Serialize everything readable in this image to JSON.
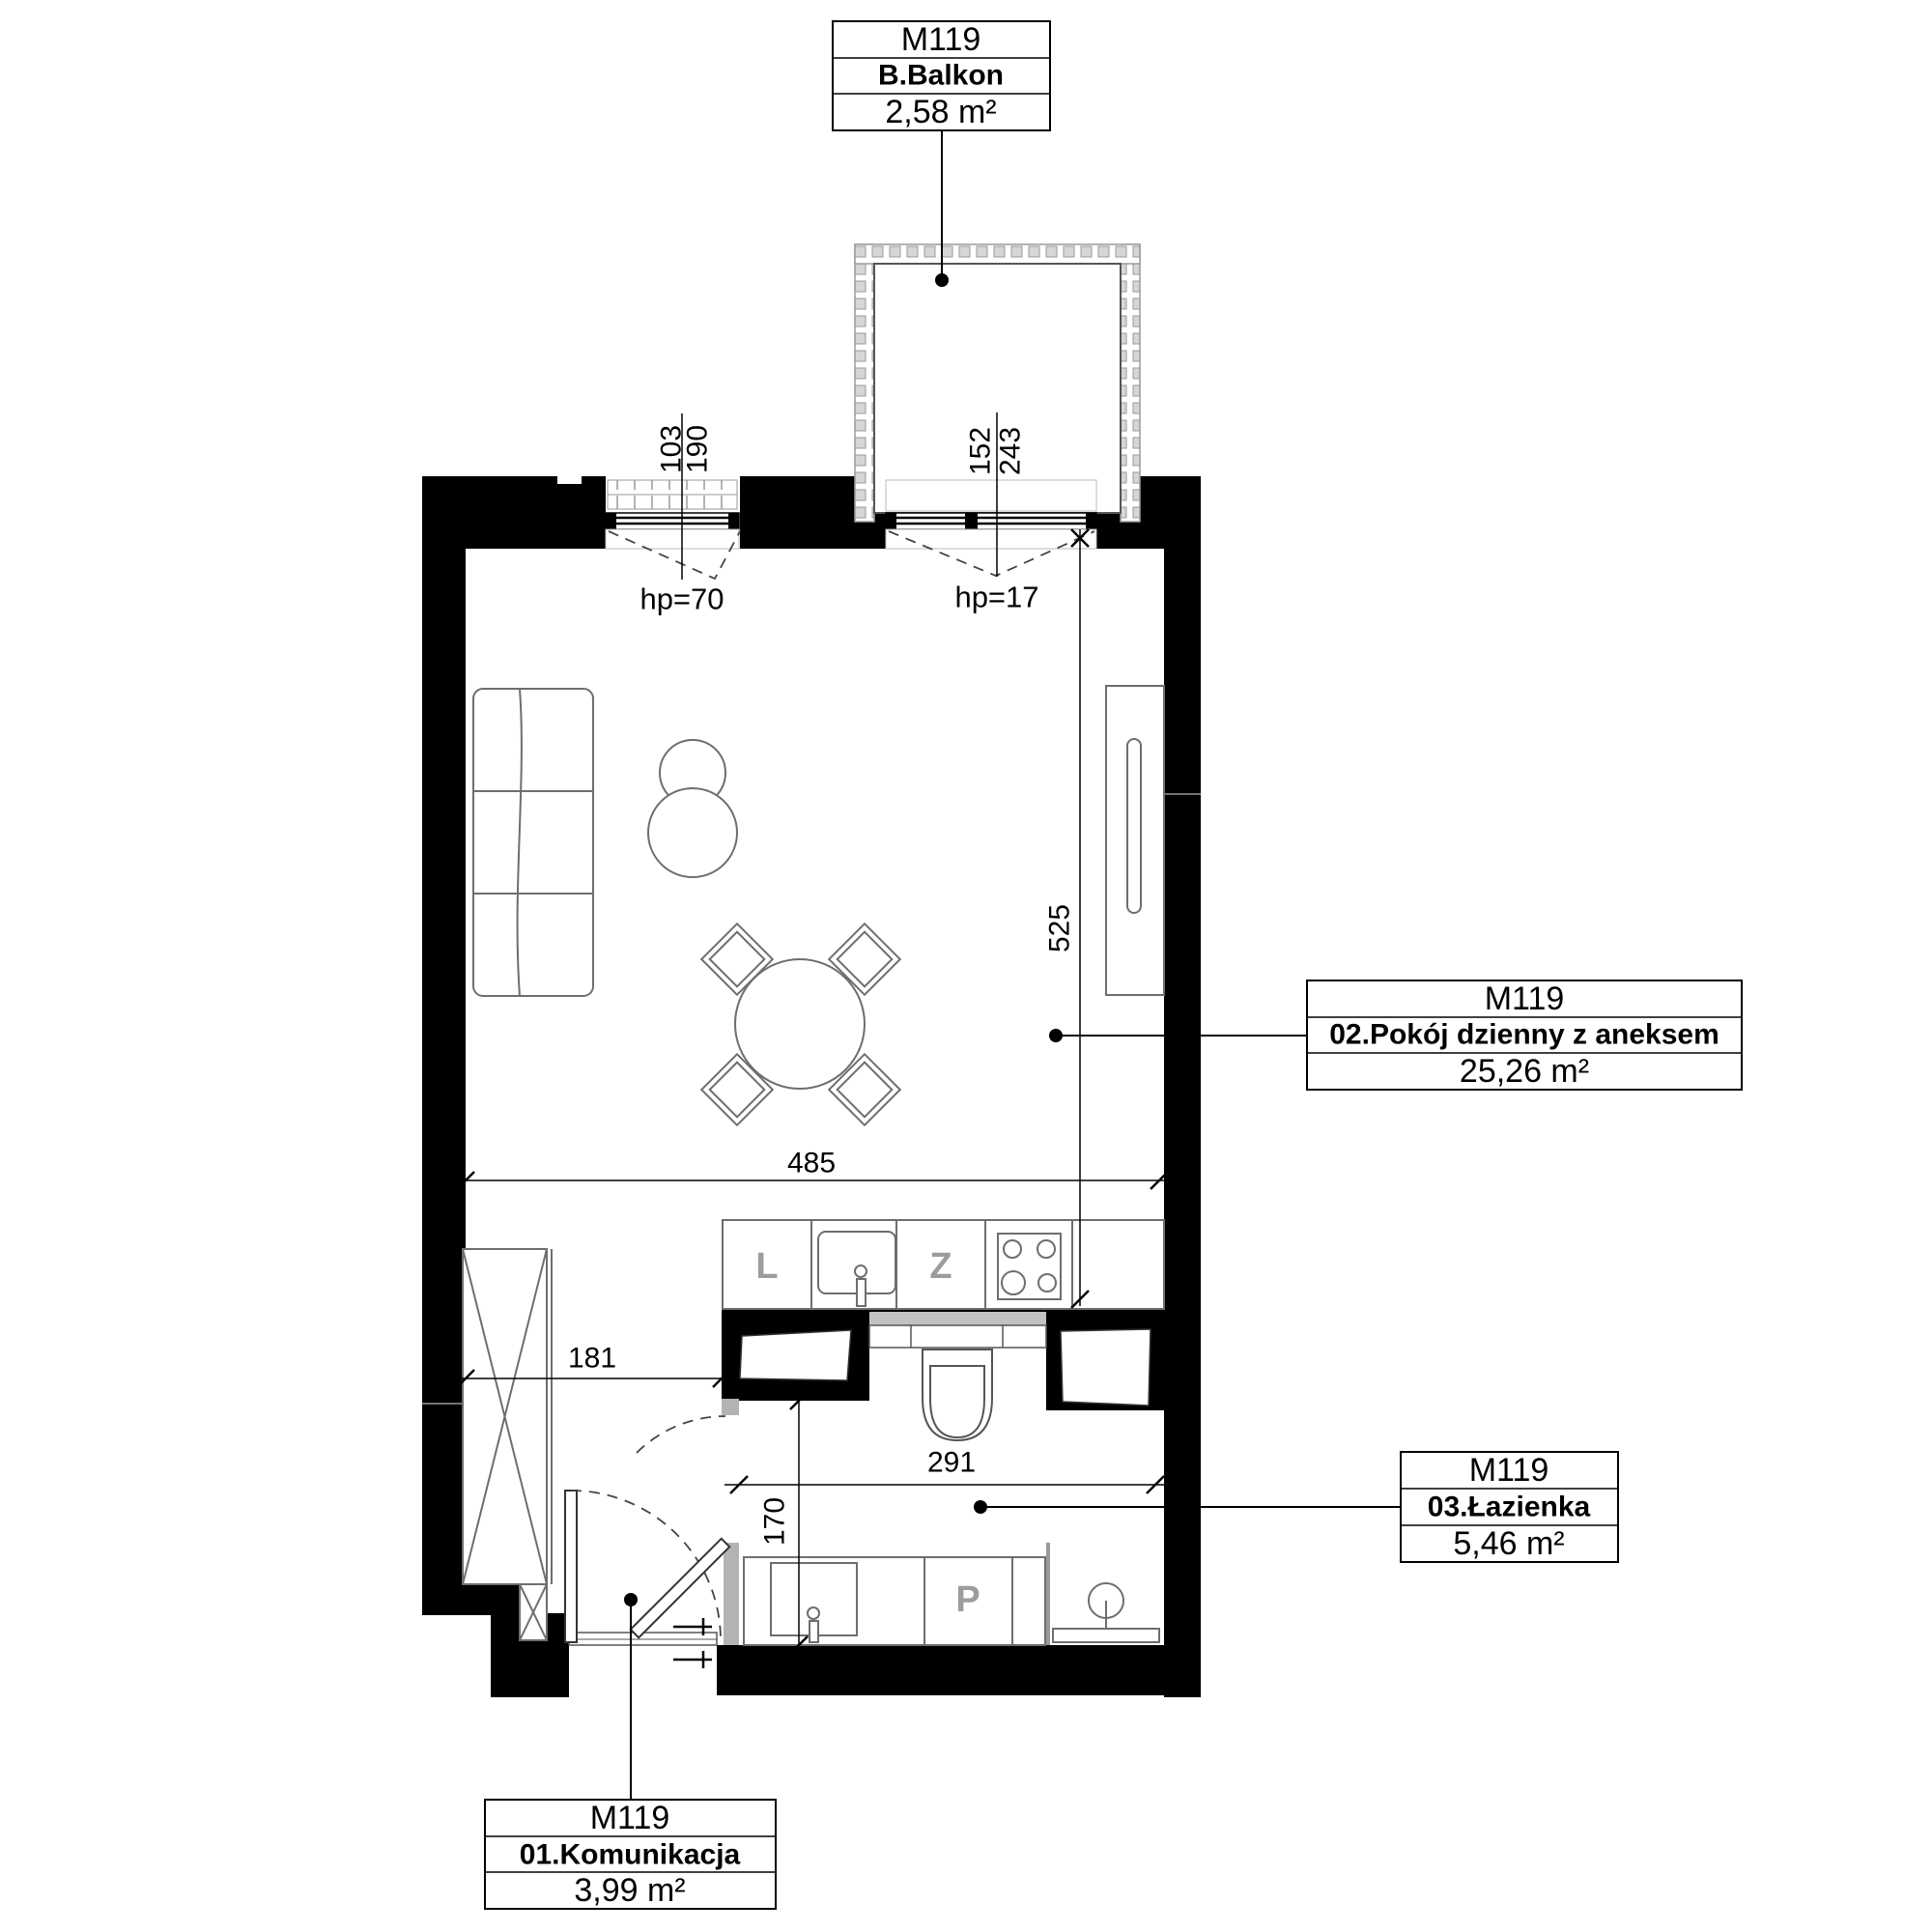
{
  "rooms": {
    "balcony": {
      "unit": "M119",
      "name": "B.Balkon",
      "area": "2,58 m²"
    },
    "living": {
      "unit": "M119",
      "name": "02.Pokój dzienny z aneksem",
      "area": "25,26 m²"
    },
    "bathroom": {
      "unit": "M119",
      "name": "03.Łazienka",
      "area": "5,46 m²"
    },
    "hallway": {
      "unit": "M119",
      "name": "01.Komunikacja",
      "area": "3,99 m²"
    }
  },
  "dimensions": {
    "win1_width": "103",
    "win1_total": "190",
    "win1_parapet": "hp=70",
    "win2_width": "152",
    "win2_total": "243",
    "win2_parapet": "hp=17",
    "living_depth": "525",
    "living_width": "485",
    "hall_width": "181",
    "bath_width": "291",
    "bath_depth": "170"
  },
  "appliances": {
    "fridge": "L",
    "dishwasher": "Z",
    "washer": "P"
  },
  "colors": {
    "wall": "#000000",
    "furniture_outline": "#6e6e6e",
    "jamb_gray": "#b3b3b3",
    "cistern_gray": "#c2c2c2"
  }
}
